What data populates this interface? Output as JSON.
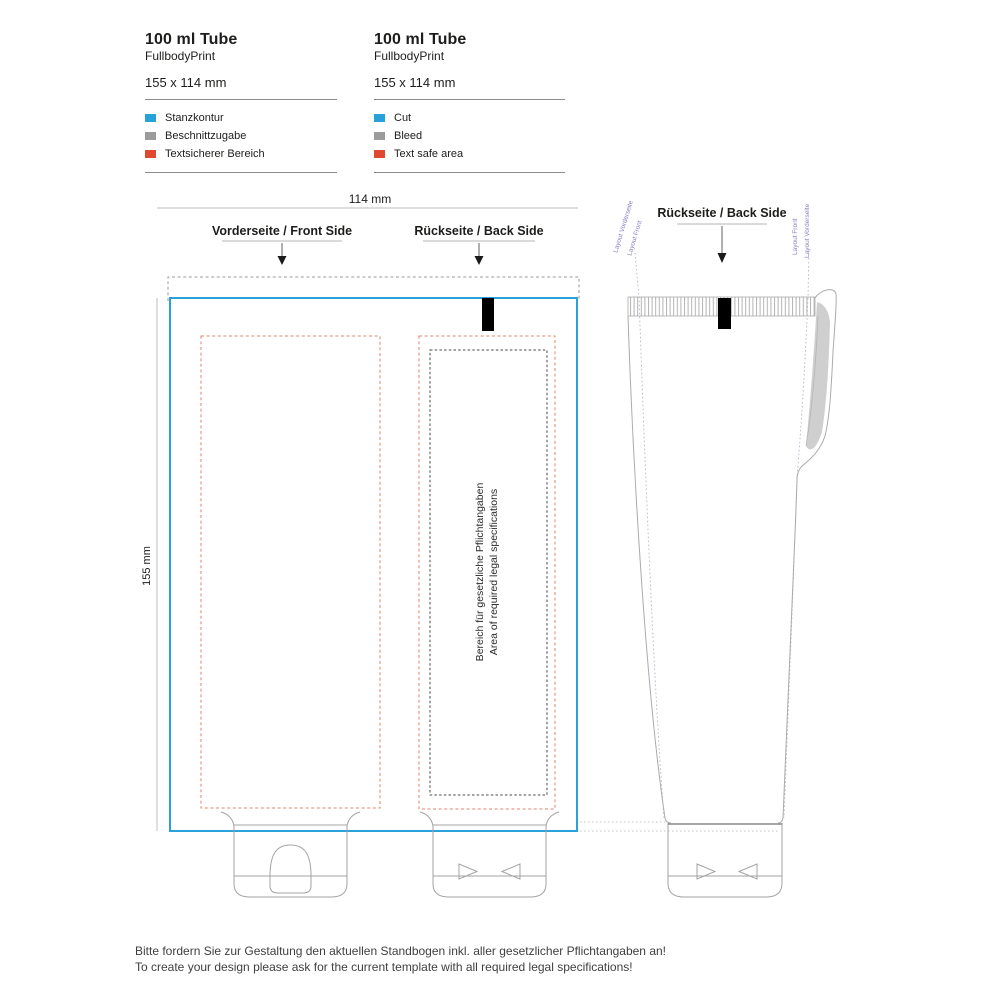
{
  "colors": {
    "cut_blue": "#29a2dc",
    "bleed_gray": "#9b9b9b",
    "safe_red": "#df4a2e",
    "safe_dash": "#e2856f",
    "layout_label_purple": "#8f81c2"
  },
  "legend_de": {
    "title": "100 ml Tube",
    "subtitle": "FullbodyPrint",
    "size": "155 x 114 mm",
    "items": [
      {
        "label": "Stanzkontur",
        "color": "#29a2dc"
      },
      {
        "label": "Beschnittzugabe",
        "color": "#9b9b9b"
      },
      {
        "label": "Textsicherer Bereich",
        "color": "#df4a2e"
      }
    ]
  },
  "legend_en": {
    "title": "100 ml Tube",
    "subtitle": "FullbodyPrint",
    "size": "155 x 114 mm",
    "items": [
      {
        "label": "Cut",
        "color": "#29a2dc"
      },
      {
        "label": "Bleed",
        "color": "#9b9b9b"
      },
      {
        "label": "Text safe area",
        "color": "#df4a2e"
      }
    ]
  },
  "dimensions": {
    "width": "114 mm",
    "height": "155 mm"
  },
  "flat": {
    "front_title": "Vorderseite / Front Side",
    "back_title": "Rückseite / Back Side",
    "legal_de": "Bereich für gesetzliche Pflichtangaben",
    "legal_en": "Area of required legal specifications"
  },
  "tube": {
    "back_title": "Rückseite / Back Side",
    "layout_left_outer": "Layout Vorderseite",
    "layout_left_inner": "Layout Front",
    "layout_right_inner": "Layout Front",
    "layout_right_outer": "Layout Vorderseite"
  },
  "footer": {
    "de": "Bitte fordern Sie zur Gestaltung den aktuellen Standbogen inkl. aller gesetzlicher Pflichtangaben an!",
    "en": "To create your design please ask for the current template with all required legal specifications!"
  }
}
